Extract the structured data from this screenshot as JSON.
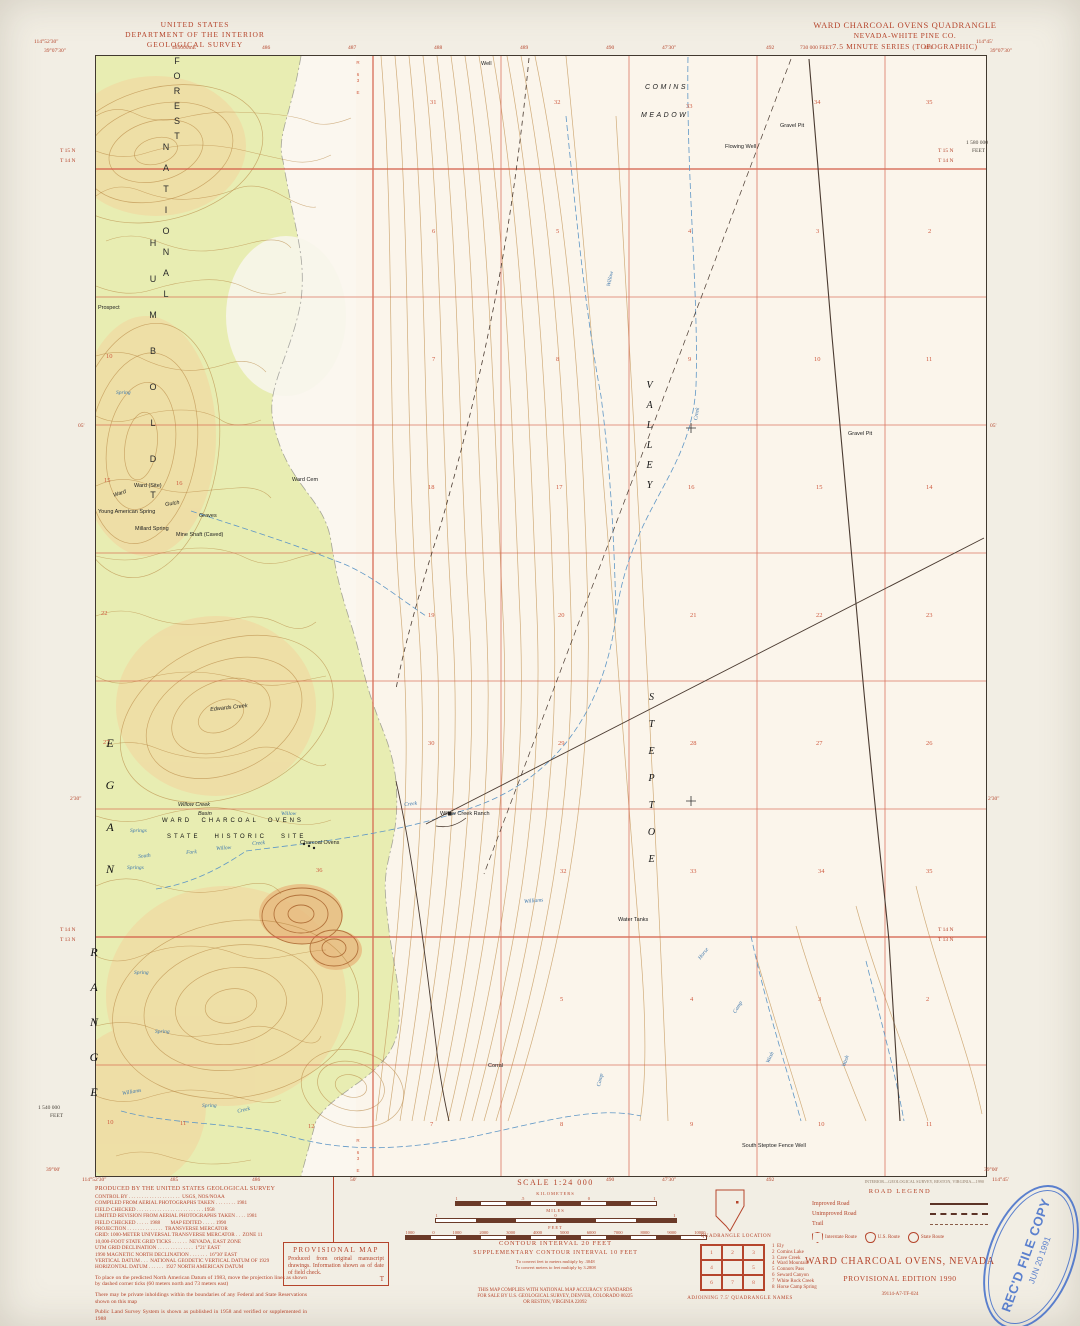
{
  "colors": {
    "margin_red": "#b5452c",
    "map_red": "#cf5b40",
    "contour_brown": "#b5823e",
    "forest_green": "#e8edb2",
    "water_blue": "#5f97c6",
    "stamp_blue": "#3565c8"
  },
  "header_left": [
    "UNITED STATES",
    "DEPARTMENT OF THE INTERIOR",
    "GEOLOGICAL SURVEY"
  ],
  "header_right": [
    "WARD CHARCOAL OVENS QUADRANGLE",
    "NEVADA-WHITE PINE CO.",
    "7.5 MINUTE SERIES (TOPOGRAPHIC)"
  ],
  "edge_labels": [
    {
      "t": "114°52'30\"",
      "x": 34,
      "y": 40
    },
    {
      "t": "39°07'30\"",
      "x": 44,
      "y": 49
    },
    {
      "t": "485000mE",
      "x": 172,
      "y": 46
    },
    {
      "t": "486",
      "x": 262,
      "y": 46
    },
    {
      "t": "487",
      "x": 348,
      "y": 46
    },
    {
      "t": "488",
      "x": 434,
      "y": 46
    },
    {
      "t": "489",
      "x": 520,
      "y": 46
    },
    {
      "t": "490",
      "x": 606,
      "y": 46
    },
    {
      "t": "47'30\"",
      "x": 662,
      "y": 46
    },
    {
      "t": "492",
      "x": 766,
      "y": 46
    },
    {
      "t": "730 000 FEET",
      "x": 800,
      "y": 46
    },
    {
      "t": "494",
      "x": 924,
      "y": 46
    },
    {
      "t": "114°45'",
      "x": 976,
      "y": 40
    },
    {
      "t": "39°07'30\"",
      "x": 990,
      "y": 49
    },
    {
      "t": "1 580 000",
      "x": 966,
      "y": 141,
      "c": "edge-dark"
    },
    {
      "t": "FEET",
      "x": 972,
      "y": 149,
      "c": "edge-dark"
    },
    {
      "t": "T 15 N",
      "x": 60,
      "y": 149
    },
    {
      "t": "T 14 N",
      "x": 60,
      "y": 159
    },
    {
      "t": "T 15 N",
      "x": 938,
      "y": 149
    },
    {
      "t": "T 14 N",
      "x": 938,
      "y": 159
    },
    {
      "t": "05'",
      "x": 78,
      "y": 424
    },
    {
      "t": "05'",
      "x": 990,
      "y": 424
    },
    {
      "t": "2'30\"",
      "x": 70,
      "y": 797
    },
    {
      "t": "2'30\"",
      "x": 988,
      "y": 797
    },
    {
      "t": "T 14 N",
      "x": 60,
      "y": 928
    },
    {
      "t": "T 13 N",
      "x": 60,
      "y": 938
    },
    {
      "t": "T 14 N",
      "x": 938,
      "y": 928
    },
    {
      "t": "T 13 N",
      "x": 938,
      "y": 938
    },
    {
      "t": "1 540 000",
      "x": 38,
      "y": 1106,
      "c": "edge-dark"
    },
    {
      "t": "FEET",
      "x": 50,
      "y": 1114,
      "c": "edge-dark"
    },
    {
      "t": "39°00'",
      "x": 46,
      "y": 1168
    },
    {
      "t": "114°52'30\"",
      "x": 82,
      "y": 1178
    },
    {
      "t": "485",
      "x": 170,
      "y": 1178
    },
    {
      "t": "50'",
      "x": 350,
      "y": 1178
    },
    {
      "t": "486",
      "x": 252,
      "y": 1178
    },
    {
      "t": "490",
      "x": 606,
      "y": 1178
    },
    {
      "t": "47'30\"",
      "x": 662,
      "y": 1178
    },
    {
      "t": "492",
      "x": 766,
      "y": 1178
    },
    {
      "t": "39°00'",
      "x": 984,
      "y": 1168
    },
    {
      "t": "114°45'",
      "x": 992,
      "y": 1178
    }
  ],
  "map_labels": [
    {
      "t": "FOREST",
      "x": 172,
      "y": 56,
      "c": "vstack lbl-nf"
    },
    {
      "t": "NATIONAL",
      "x": 161,
      "y": 142,
      "c": "vstack lbl-nf",
      "ls": 11
    },
    {
      "t": "HUMBOLDT",
      "x": 148,
      "y": 238,
      "c": "vstack lbl-nf",
      "ls": 26
    },
    {
      "t": "EGAN",
      "x": 104,
      "y": 736,
      "c": "vstack lbl-range"
    },
    {
      "t": "RANGE",
      "x": 88,
      "y": 945,
      "c": "vstack lbl-range",
      "ls": 21
    },
    {
      "t": "STEPTOE",
      "x": 646,
      "y": 692,
      "c": "vstack lbl-valley",
      "ls": 16
    },
    {
      "t": "VALLEY",
      "x": 644,
      "y": 380,
      "c": "vstack lbl-valley",
      "ls": 9
    },
    {
      "t": "COMINS",
      "x": 645,
      "y": 84,
      "c": "lbl-area"
    },
    {
      "t": "MEADOW",
      "x": 641,
      "y": 112,
      "c": "lbl-area"
    },
    {
      "t": "WARD  CHARCOAL  OVENS",
      "x": 162,
      "y": 818,
      "c": "lbl-site"
    },
    {
      "t": "STATE   HISTORIC   SITE",
      "x": 167,
      "y": 834,
      "c": "lbl-site"
    },
    {
      "t": "Willow Creek",
      "x": 178,
      "y": 803,
      "c": "lbl-si"
    },
    {
      "t": "Basin",
      "x": 198,
      "y": 812,
      "c": "lbl-si"
    },
    {
      "t": "Willow Creek Ranch",
      "x": 440,
      "y": 812,
      "c": "lbl-s"
    },
    {
      "t": "Charcoal Ovens",
      "x": 300,
      "y": 841,
      "c": "lbl-s"
    },
    {
      "t": "Ward Cem",
      "x": 292,
      "y": 478,
      "c": "lbl-s"
    },
    {
      "t": "Ward",
      "x": 113,
      "y": 494,
      "c": "lbl-si",
      "r": -18
    },
    {
      "t": "Gulch",
      "x": 165,
      "y": 503,
      "c": "lbl-si",
      "r": -8
    },
    {
      "t": "Ward (Site)",
      "x": 134,
      "y": 484,
      "c": "lbl-s"
    },
    {
      "t": "Young American Spring",
      "x": 98,
      "y": 510,
      "c": "lbl-s"
    },
    {
      "t": "Millard Spring",
      "x": 135,
      "y": 527,
      "c": "lbl-s"
    },
    {
      "t": "Mine Shaft (Caved)",
      "x": 176,
      "y": 533,
      "c": "lbl-s"
    },
    {
      "t": "Graves",
      "x": 199,
      "y": 514,
      "c": "lbl-s"
    },
    {
      "t": "Prospect",
      "x": 98,
      "y": 306,
      "c": "lbl-s"
    },
    {
      "t": "Well",
      "x": 481,
      "y": 62,
      "c": "lbl-s"
    },
    {
      "t": "Flowing Well",
      "x": 725,
      "y": 145,
      "c": "lbl-s"
    },
    {
      "t": "Gravel Pit",
      "x": 780,
      "y": 124,
      "c": "lbl-s"
    },
    {
      "t": "Gravel Pit",
      "x": 848,
      "y": 432,
      "c": "lbl-s"
    },
    {
      "t": "Water Tanks",
      "x": 618,
      "y": 918,
      "c": "lbl-s"
    },
    {
      "t": "Corral",
      "x": 488,
      "y": 1064,
      "c": "lbl-s"
    },
    {
      "t": "South Steptoe Fence Well",
      "x": 742,
      "y": 1144,
      "c": "lbl-s"
    },
    {
      "t": "Edwards Creek",
      "x": 210,
      "y": 708,
      "c": "lbl-si",
      "r": -6
    },
    {
      "t": "Willow",
      "x": 281,
      "y": 812,
      "c": "lbl-b"
    },
    {
      "t": "Creek",
      "x": 404,
      "y": 803,
      "c": "lbl-b",
      "r": -6
    },
    {
      "t": "South",
      "x": 138,
      "y": 855,
      "c": "lbl-b",
      "r": -6
    },
    {
      "t": "Fork",
      "x": 186,
      "y": 851,
      "c": "lbl-b",
      "r": -4
    },
    {
      "t": "Willow",
      "x": 216,
      "y": 847,
      "c": "lbl-b",
      "r": -4
    },
    {
      "t": "Creek",
      "x": 252,
      "y": 842,
      "c": "lbl-b",
      "r": -4
    },
    {
      "t": "Springs",
      "x": 130,
      "y": 829,
      "c": "lbl-b"
    },
    {
      "t": "Springs",
      "x": 127,
      "y": 866,
      "c": "lbl-b"
    },
    {
      "t": "Spring",
      "x": 116,
      "y": 391,
      "c": "lbl-b"
    },
    {
      "t": "Spring",
      "x": 134,
      "y": 971,
      "c": "lbl-b"
    },
    {
      "t": "Spring",
      "x": 155,
      "y": 1030,
      "c": "lbl-b"
    },
    {
      "t": "Spring",
      "x": 202,
      "y": 1104,
      "c": "lbl-b"
    },
    {
      "t": "Williams",
      "x": 122,
      "y": 1092,
      "c": "lbl-b",
      "r": -10
    },
    {
      "t": "Creek",
      "x": 237,
      "y": 1110,
      "c": "lbl-b",
      "r": -14
    },
    {
      "t": "Williams",
      "x": 524,
      "y": 900,
      "c": "lbl-b",
      "r": -5
    },
    {
      "t": "Willow",
      "x": 607,
      "y": 286,
      "c": "lbl-b",
      "r": -78
    },
    {
      "t": "Creek",
      "x": 694,
      "y": 420,
      "c": "lbl-b",
      "r": -80
    },
    {
      "t": "Horse",
      "x": 698,
      "y": 958,
      "c": "lbl-b",
      "r": -52
    },
    {
      "t": "Camp",
      "x": 733,
      "y": 1012,
      "c": "lbl-b",
      "r": -58
    },
    {
      "t": "Wash",
      "x": 766,
      "y": 1062,
      "c": "lbl-b",
      "r": -64
    },
    {
      "t": "Wash",
      "x": 842,
      "y": 1066,
      "c": "lbl-b",
      "r": -70
    },
    {
      "t": "Camp",
      "x": 597,
      "y": 1086,
      "c": "lbl-b",
      "r": -76
    },
    {
      "t": "R 63 E",
      "x": 355,
      "y": 60,
      "c": "vstack lbl-r"
    },
    {
      "t": "R 63 E",
      "x": 355,
      "y": 1138,
      "c": "vstack lbl-r"
    },
    {
      "t": "31",
      "x": 430,
      "y": 100,
      "c": "lbl-sec"
    },
    {
      "t": "32",
      "x": 554,
      "y": 100,
      "c": "lbl-sec"
    },
    {
      "t": "33",
      "x": 686,
      "y": 104,
      "c": "lbl-sec"
    },
    {
      "t": "34",
      "x": 814,
      "y": 100,
      "c": "lbl-sec"
    },
    {
      "t": "35",
      "x": 926,
      "y": 100,
      "c": "lbl-sec"
    },
    {
      "t": "6",
      "x": 432,
      "y": 229,
      "c": "lbl-sec"
    },
    {
      "t": "5",
      "x": 556,
      "y": 229,
      "c": "lbl-sec"
    },
    {
      "t": "4",
      "x": 688,
      "y": 229,
      "c": "lbl-sec"
    },
    {
      "t": "3",
      "x": 816,
      "y": 229,
      "c": "lbl-sec"
    },
    {
      "t": "2",
      "x": 928,
      "y": 229,
      "c": "lbl-sec"
    },
    {
      "t": "7",
      "x": 432,
      "y": 357,
      "c": "lbl-sec"
    },
    {
      "t": "8",
      "x": 556,
      "y": 357,
      "c": "lbl-sec"
    },
    {
      "t": "9",
      "x": 688,
      "y": 357,
      "c": "lbl-sec"
    },
    {
      "t": "10",
      "x": 814,
      "y": 357,
      "c": "lbl-sec"
    },
    {
      "t": "11",
      "x": 926,
      "y": 357,
      "c": "lbl-sec"
    },
    {
      "t": "10",
      "x": 106,
      "y": 354,
      "c": "lbl-sec"
    },
    {
      "t": "18",
      "x": 428,
      "y": 485,
      "c": "lbl-sec"
    },
    {
      "t": "17",
      "x": 556,
      "y": 485,
      "c": "lbl-sec"
    },
    {
      "t": "16",
      "x": 688,
      "y": 485,
      "c": "lbl-sec"
    },
    {
      "t": "15",
      "x": 816,
      "y": 485,
      "c": "lbl-sec"
    },
    {
      "t": "14",
      "x": 926,
      "y": 485,
      "c": "lbl-sec"
    },
    {
      "t": "15",
      "x": 104,
      "y": 478,
      "c": "lbl-sec"
    },
    {
      "t": "16",
      "x": 176,
      "y": 481,
      "c": "lbl-sec"
    },
    {
      "t": "19",
      "x": 428,
      "y": 613,
      "c": "lbl-sec"
    },
    {
      "t": "20",
      "x": 558,
      "y": 613,
      "c": "lbl-sec"
    },
    {
      "t": "21",
      "x": 690,
      "y": 613,
      "c": "lbl-sec"
    },
    {
      "t": "22",
      "x": 816,
      "y": 613,
      "c": "lbl-sec"
    },
    {
      "t": "23",
      "x": 926,
      "y": 613,
      "c": "lbl-sec"
    },
    {
      "t": "22",
      "x": 101,
      "y": 611,
      "c": "lbl-sec"
    },
    {
      "t": "30",
      "x": 428,
      "y": 741,
      "c": "lbl-sec"
    },
    {
      "t": "29",
      "x": 558,
      "y": 741,
      "c": "lbl-sec"
    },
    {
      "t": "28",
      "x": 690,
      "y": 741,
      "c": "lbl-sec"
    },
    {
      "t": "27",
      "x": 816,
      "y": 741,
      "c": "lbl-sec"
    },
    {
      "t": "26",
      "x": 926,
      "y": 741,
      "c": "lbl-sec"
    },
    {
      "t": "27",
      "x": 103,
      "y": 740,
      "c": "lbl-sec"
    },
    {
      "t": "32",
      "x": 560,
      "y": 869,
      "c": "lbl-sec"
    },
    {
      "t": "33",
      "x": 690,
      "y": 869,
      "c": "lbl-sec"
    },
    {
      "t": "34",
      "x": 818,
      "y": 869,
      "c": "lbl-sec"
    },
    {
      "t": "35",
      "x": 926,
      "y": 869,
      "c": "lbl-sec"
    },
    {
      "t": "36",
      "x": 316,
      "y": 868,
      "c": "lbl-sec"
    },
    {
      "t": "5",
      "x": 560,
      "y": 997,
      "c": "lbl-sec"
    },
    {
      "t": "4",
      "x": 690,
      "y": 997,
      "c": "lbl-sec"
    },
    {
      "t": "3",
      "x": 818,
      "y": 997,
      "c": "lbl-sec"
    },
    {
      "t": "2",
      "x": 926,
      "y": 997,
      "c": "lbl-sec"
    },
    {
      "t": "8",
      "x": 560,
      "y": 1122,
      "c": "lbl-sec"
    },
    {
      "t": "9",
      "x": 690,
      "y": 1122,
      "c": "lbl-sec"
    },
    {
      "t": "10",
      "x": 818,
      "y": 1122,
      "c": "lbl-sec"
    },
    {
      "t": "11",
      "x": 926,
      "y": 1122,
      "c": "lbl-sec"
    },
    {
      "t": "10",
      "x": 107,
      "y": 1120,
      "c": "lbl-sec"
    },
    {
      "t": "11",
      "x": 180,
      "y": 1121,
      "c": "lbl-sec"
    },
    {
      "t": "12",
      "x": 308,
      "y": 1124,
      "c": "lbl-sec"
    },
    {
      "t": "7",
      "x": 430,
      "y": 1122,
      "c": "lbl-sec"
    }
  ],
  "credits": {
    "title": "PRODUCED BY THE UNITED STATES GEOLOGICAL SURVEY",
    "lines": [
      "CONTROL BY . . . . . . . . . . . . . . . . . . . .  USGS, NOS/NOAA",
      "COMPILED FROM AERIAL PHOTOGRAPHS TAKEN . . . . . . . . 1981",
      "FIELD CHECKED . . . . . . . . . . . . . . . . . . . . . . . . . . 1958",
      "LIMITED REVISION FROM AERIAL PHOTOGRAPHS TAKEN . . . . 1981",
      "FIELD CHECKED . . . . . 1988        MAP EDITED . . . . . 1990",
      "PROJECTION . . . . . . . . . . . . . .  TRANSVERSE MERCATOR",
      "GRID: 1000-METER UNIVERSAL TRANSVERSE MERCATOR . .  ZONE 11",
      "10,000-FOOT STATE GRID TICKS . . . . . .  NEVADA, EAST ZONE",
      "UTM GRID DECLINATION . . . . . . . . . . . . . .  1°21' EAST",
      "1990 MAGNETIC NORTH DECLINATION . . . . . . .  16°30' EAST",
      "VERTICAL DATUM . . .  NATIONAL GEODETIC VERTICAL DATUM OF 1929",
      "HORIZONTAL DATUM . . . . . .  1927 NORTH AMERICAN DATUM"
    ],
    "paragraphs": [
      "To place on the predicted North American Datum of 1983, move the projection lines as shown by dashed corner ticks (60 meters north and 73 meters east)",
      "There may be private inholdings within the boundaries of any Federal and State Reservations shown on this map",
      "Public Land Survey System is shown as published in 1958 and verified or supplemented in 1988"
    ]
  },
  "provisional_box": {
    "title": "PROVISIONAL MAP",
    "body": "Produced from original manuscript drawings. Information shown as of date of field check.",
    "corner": "T"
  },
  "scale": {
    "label": "SCALE 1:24 000",
    "bars": [
      {
        "unit": "KILOMETERS",
        "ticks": [
          "1",
          ".5",
          "0",
          "1"
        ]
      },
      {
        "unit": "MILES",
        "ticks": [
          "1",
          "0",
          "1"
        ]
      },
      {
        "unit": "FEET",
        "ticks": [
          "1000",
          "0",
          "1000",
          "2000",
          "3000",
          "4000",
          "5000",
          "6000",
          "7000",
          "8000",
          "9000",
          "10000"
        ]
      }
    ]
  },
  "contour_info": {
    "line1": "CONTOUR INTERVAL 20 FEET",
    "line2": "SUPPLEMENTARY CONTOUR INTERVAL 10 FEET",
    "conv1": "To convert feet to meters multiply by .3048",
    "conv2": "To convert meters to feet multiply by 3.2808"
  },
  "compliance": [
    "THIS MAP COMPLIES WITH NATIONAL MAP ACCURACY STANDARDS",
    "FOR SALE BY U.S. GEOLOGICAL SURVEY, DENVER, COLORADO 80225",
    "OR RESTON, VIRGINIA 22092"
  ],
  "location": {
    "caption": "QUADRANGLE LOCATION"
  },
  "adjoining": {
    "caption": "ADJOINING 7.5' QUADRANGLE NAMES",
    "cells": [
      "1",
      "2",
      "3",
      "4",
      "",
      "5",
      "6",
      "7",
      "8"
    ],
    "names": [
      "1  Ely",
      "2  Comins Lake",
      "3  Cave Creek",
      "4  Ward Mountain",
      "5  Connors Pass",
      "6  Seward Canyon",
      "7  White Rock Creek",
      "8  Horse Camp Spring"
    ]
  },
  "road_legend": {
    "title": "ROAD LEGEND",
    "rows": [
      {
        "label": "Improved Road"
      },
      {
        "label": "Unimproved Road"
      },
      {
        "label": "Trail"
      }
    ],
    "routes": [
      "Interstate Route",
      "U.S. Route",
      "State Route"
    ]
  },
  "title_block": {
    "name": "WARD CHARCOAL OVENS, NEVADA",
    "edition": "PROVISIONAL EDITION 1990",
    "code": "39114-A7-TF-024"
  },
  "stamp": {
    "line1": "REC'D FILE COPY",
    "line2": "JUN 20 1991"
  },
  "imprint": "INTERIOR—GEOLOGICAL SURVEY, RESTON, VIRGINIA—1990"
}
